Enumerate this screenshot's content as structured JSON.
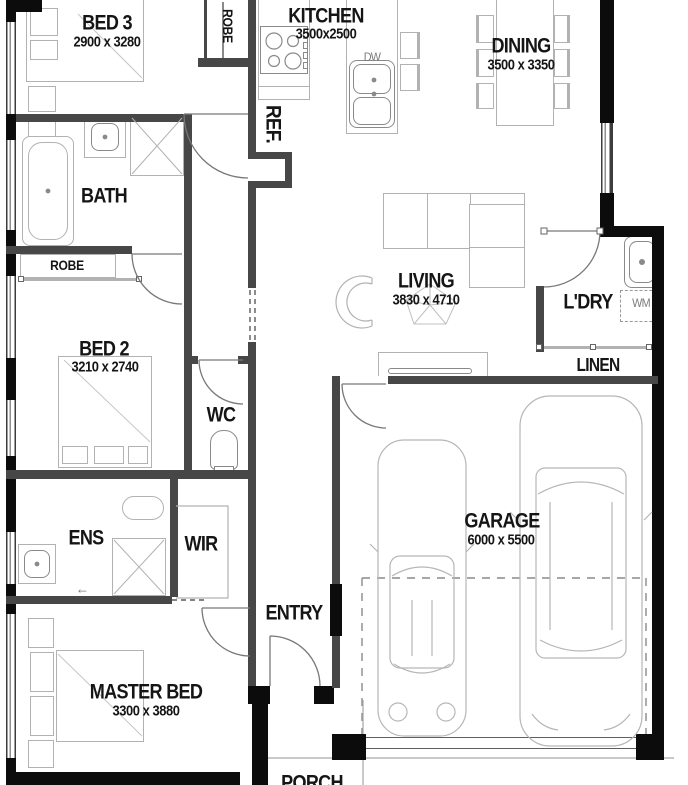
{
  "rooms": {
    "bed3": {
      "name": "BED 3",
      "dims": "2900 x 3280"
    },
    "kitchen": {
      "name": "KITCHEN",
      "dims": "3500x2500"
    },
    "dining": {
      "name": "DINING",
      "dims": "3500 x 3350"
    },
    "bath": {
      "name": "BATH"
    },
    "robe_bed3": {
      "name": "ROBE"
    },
    "robe_bed2": {
      "name": "ROBE"
    },
    "bed2": {
      "name": "BED 2",
      "dims": "3210 x 2740"
    },
    "living": {
      "name": "LIVING",
      "dims": "3830 x 4710"
    },
    "laundry": {
      "name": "L'DRY"
    },
    "linen": {
      "name": "LINEN"
    },
    "wc": {
      "name": "WC"
    },
    "ens": {
      "name": "ENS"
    },
    "wir": {
      "name": "WIR"
    },
    "garage": {
      "name": "GARAGE",
      "dims": "6000 x 5500"
    },
    "entry": {
      "name": "ENTRY"
    },
    "master": {
      "name": "MASTER BED",
      "dims": "3300 x 3880"
    },
    "porch": {
      "name": "PORCH"
    }
  },
  "appliances": {
    "fridge": {
      "label": "REF."
    },
    "dishwasher": {
      "label": "DW"
    },
    "washing_machine": {
      "label": "WM"
    }
  },
  "misc": {
    "entry_arrow": "←"
  },
  "colors": {
    "wall_interior": "#474747",
    "wall_structural": "#0c0c0c",
    "furniture_line": "#b2b2b2",
    "label_text": "#151515",
    "appliance_text": "#7d7d7d",
    "background": "#ffffff"
  }
}
